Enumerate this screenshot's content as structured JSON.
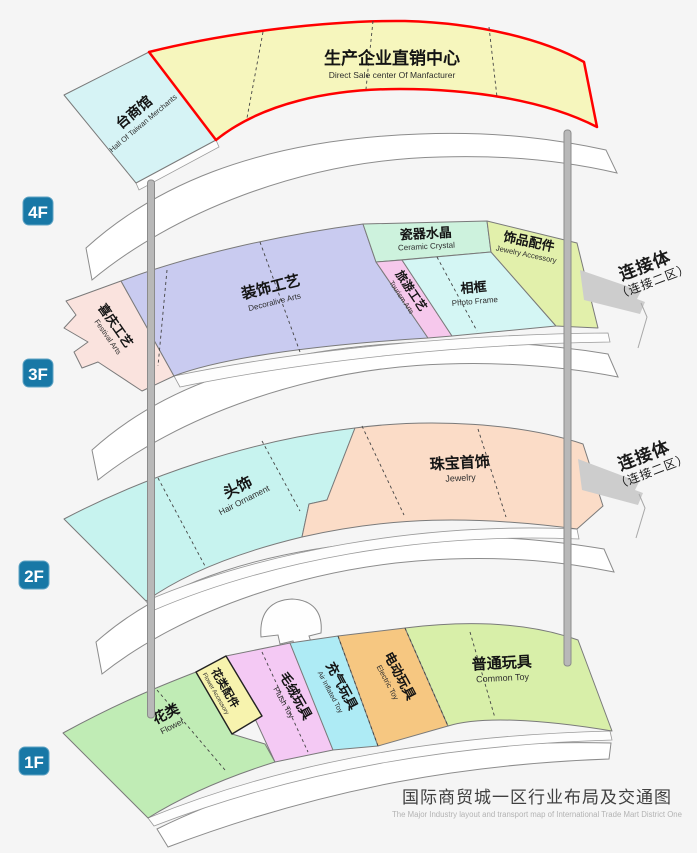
{
  "title": {
    "zh": "国际商贸城一区行业布局及交通图",
    "en": "The Major Industry layout and transport map of International Trade Mart District One"
  },
  "map": {
    "colors": {
      "background": "#f5f5f5",
      "badge_blue": "#1878a6",
      "red_border": "#ff0000",
      "walkway_fill": "#ffffff",
      "walkway_stroke": "#8c8c8c",
      "pole_gray": "#b8b8b8",
      "ribbon_gray": "#cdcdcd"
    },
    "floors": [
      {
        "badge": "4F",
        "sections": [
          {
            "key": "taiwan-hall",
            "zh": "台商馆",
            "en": "Hall Of Taiwan Merchants",
            "color": "#d6f3f5"
          },
          {
            "key": "direct-sale-center",
            "zh": "生产企业直销中心",
            "en": "Direct Sale center Of Manfacturer",
            "color": "#f6f6bd"
          }
        ]
      },
      {
        "badge": "3F",
        "sections": [
          {
            "key": "festival-arts",
            "zh": "喜庆工艺",
            "en": "Festival Arts",
            "color": "#fae3de"
          },
          {
            "key": "decorative-arts",
            "zh": "装饰工艺",
            "en": "Decoralive Arts",
            "color": "#c9cbf0"
          },
          {
            "key": "ceramic-crystal",
            "zh": "瓷器水晶",
            "en": "Ceramic Crystal",
            "color": "#cdf2dd"
          },
          {
            "key": "tourism-arts",
            "zh": "旅游工艺",
            "en": "Tourism Arts",
            "color": "#f6c8ec"
          },
          {
            "key": "photo-frame",
            "zh": "相框",
            "en": "Photo Frame",
            "color": "#d4f6f4"
          },
          {
            "key": "jewelry-accessory",
            "zh": "饰品配件",
            "en": "Jewelry Accessory",
            "color": "#e2f0ab"
          }
        ]
      },
      {
        "badge": "2F",
        "sections": [
          {
            "key": "hair-ornament",
            "zh": "头饰",
            "en": "Hair Ornament",
            "color": "#c7f3ef"
          },
          {
            "key": "jewelry",
            "zh": "珠宝首饰",
            "en": "Jewelry",
            "color": "#fbdcc7"
          }
        ]
      },
      {
        "badge": "1F",
        "sections": [
          {
            "key": "flower",
            "zh": "花类",
            "en": "Flower",
            "color": "#c0ecb5"
          },
          {
            "key": "flower-accessory",
            "zh": "花类配件",
            "en": "Flower Accessory",
            "color": "#f7f3ae"
          },
          {
            "key": "plush-toy",
            "zh": "毛绒玩具",
            "en": "Plush Toy",
            "color": "#f4c9f4"
          },
          {
            "key": "air-inflated-toy",
            "zh": "充气玩具",
            "en": "Air Inflated Toy",
            "color": "#aeebf5"
          },
          {
            "key": "electric-toy",
            "zh": "电动玩具",
            "en": "Electric Toy",
            "color": "#f6c781"
          },
          {
            "key": "common-toy",
            "zh": "普通玩具",
            "en": "Common Toy",
            "color": "#d8efa9"
          }
        ]
      }
    ],
    "connectors": [
      {
        "zh": "连接体",
        "sub": "（连接二区）"
      },
      {
        "zh": "连接体",
        "sub": "（连接二区）"
      }
    ]
  }
}
